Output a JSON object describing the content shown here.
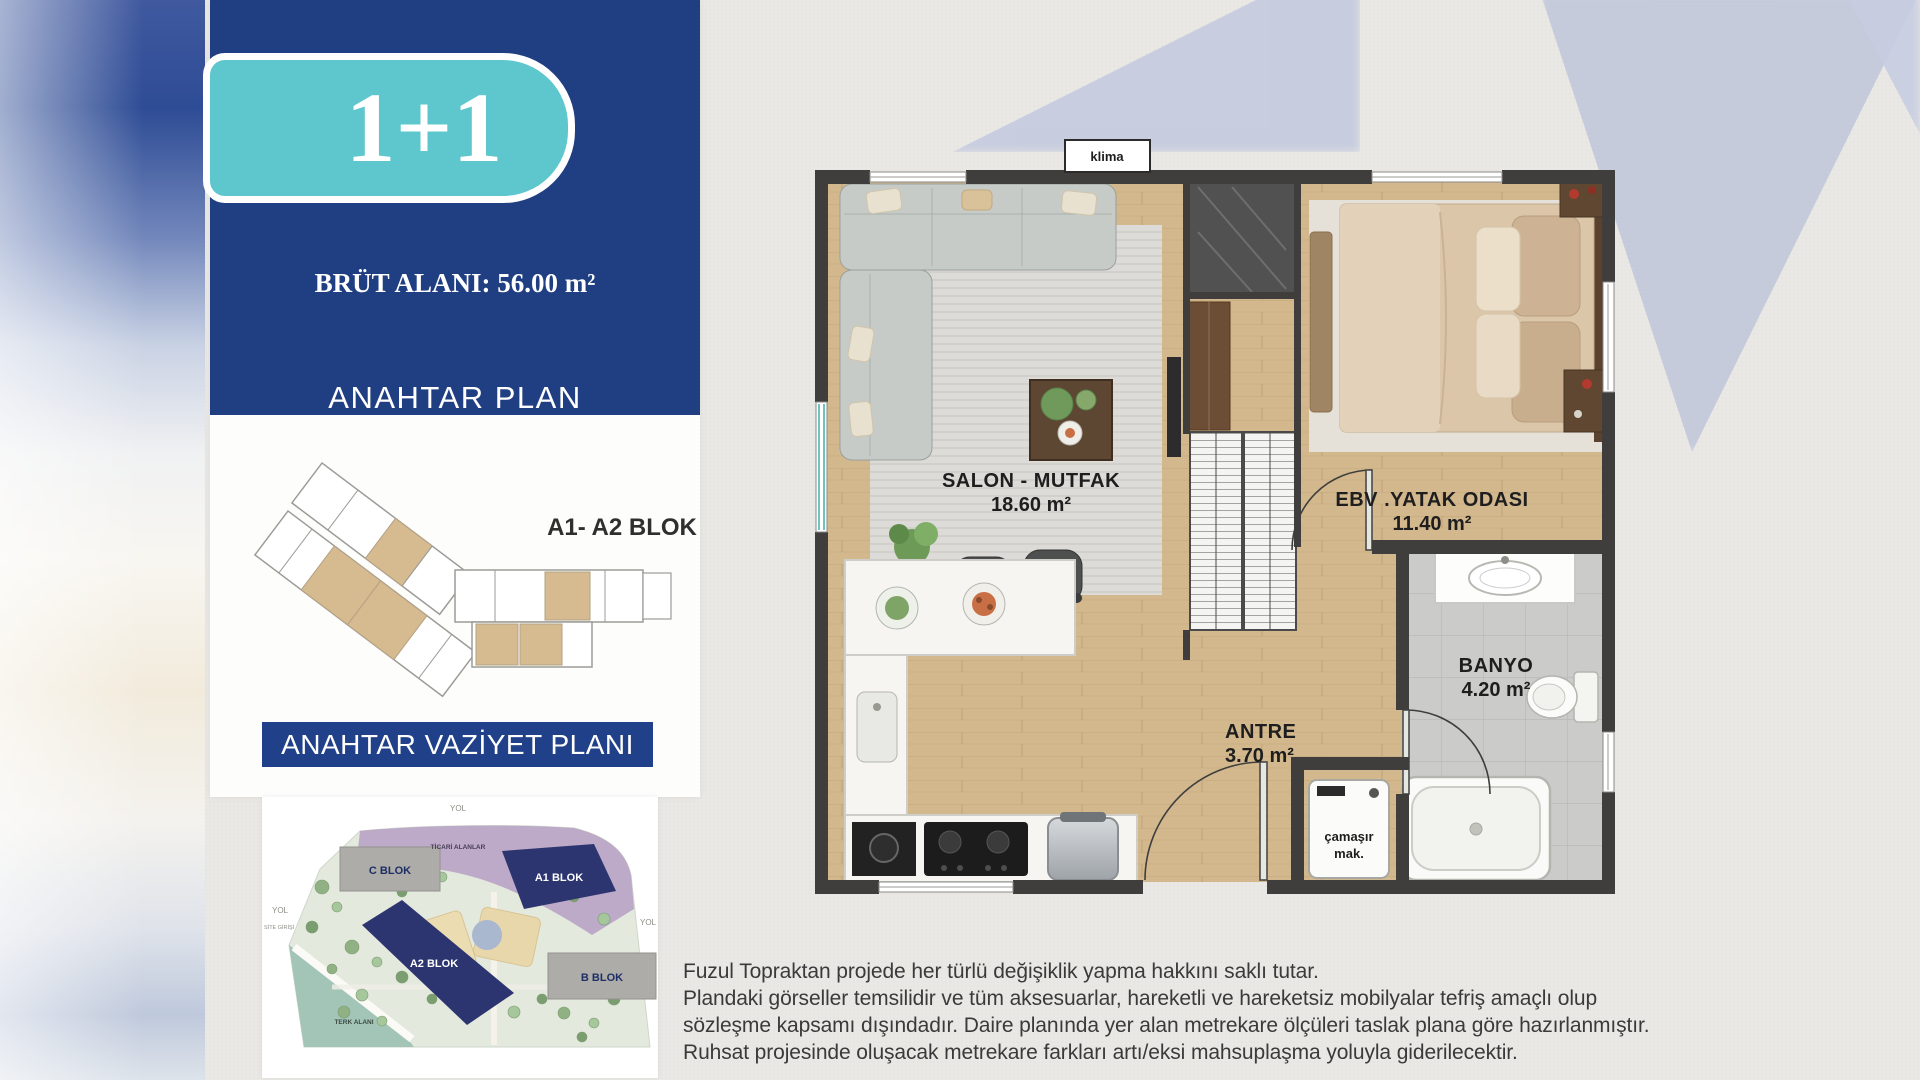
{
  "badge": {
    "label": "1+1"
  },
  "header": {
    "area_label": "BRÜT ALANI: 56.00 m²",
    "key_plan_title": "ANAHTAR PLAN"
  },
  "key_plan": {
    "block_label": "A1- A2 BLOK"
  },
  "site_plan": {
    "title": "ANAHTAR VAZİYET PLANI",
    "road_top": "YOL",
    "road_left": "YOL",
    "road_right": "YOL",
    "site_entrance": "SİTE GİRİŞİ",
    "commercial_areas": "TİCARİ ALANLAR",
    "terk_alani": "TERK ALANI",
    "blocks": [
      {
        "name": "C BLOK",
        "style": "grey"
      },
      {
        "name": "A1 BLOK",
        "style": "navy"
      },
      {
        "name": "A2 BLOK",
        "style": "navy"
      },
      {
        "name": "B BLOK",
        "style": "grey"
      }
    ]
  },
  "floor_plan": {
    "ac_unit": "klima",
    "rooms": [
      {
        "name": "SALON - MUTFAK",
        "area": "18.60 m²"
      },
      {
        "name": "EBV .YATAK ODASI",
        "area": "11.40 m²"
      },
      {
        "name": "ANTRE",
        "area": "3.70 m²"
      },
      {
        "name": "BANYO",
        "area": "4.20 m²"
      }
    ],
    "washer_line1": "çamaşır",
    "washer_line2": "mak."
  },
  "disclaimer": {
    "line1": "Fuzul Topraktan projede her türlü değişiklik yapma hakkını saklı tutar.",
    "line2": "Plandaki görseller temsilidir ve tüm aksesuarlar, hareketli ve hareketsiz mobilyalar tefriş amaçlı olup",
    "line3": "sözleşme kapsamı dışındadır. Daire planında yer alan metrekare ölçüleri taslak plana göre hazırlanmıştır.",
    "line4": "Ruhsat projesinde oluşacak metrekare farkları artı/eksi mahsuplaşma yoluyla giderilecektir."
  },
  "colors": {
    "panel_blue": "#203e82",
    "badge_teal": "#5ec7cd",
    "navy_block": "#2c356f",
    "tan_unit": "#d6ba90",
    "wall": "#3f3e3d"
  }
}
